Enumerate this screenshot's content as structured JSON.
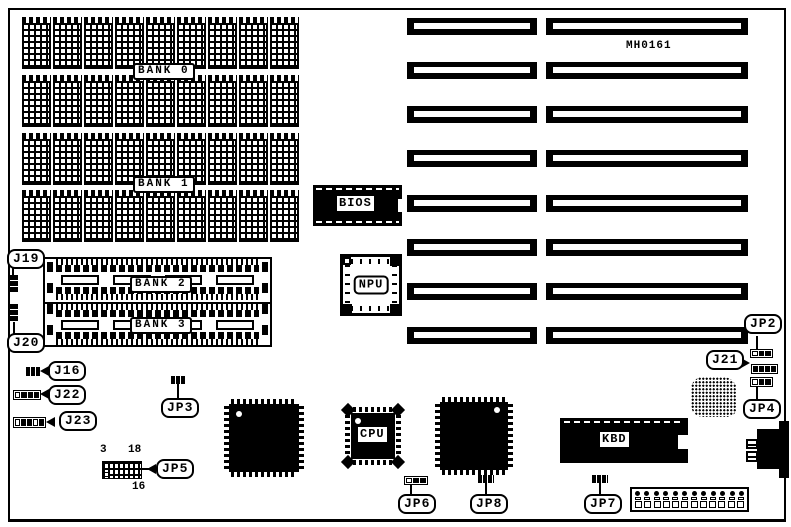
{
  "board": {
    "id_text": "MH0161",
    "dip_memory": {
      "rows": 4,
      "chips_per_row": 9,
      "banks": [
        {
          "label": "BANK 0"
        },
        {
          "label": "BANK 1"
        }
      ]
    },
    "simm_memory": {
      "banks": [
        {
          "label": "BANK 2"
        },
        {
          "label": "BANK 3"
        }
      ]
    },
    "chips": {
      "bios": "BIOS",
      "npu": "NPU",
      "cpu": "CPU",
      "kbd": "KBD"
    },
    "expansion_slots": {
      "rows": 8,
      "columns": 2
    },
    "power_connector": {
      "positions": 12
    },
    "callouts": {
      "j19": "J19",
      "j20": "J20",
      "j16": "J16",
      "j22": "J22",
      "j23": "J23",
      "jp3": "JP3",
      "jp5": "JP5",
      "jp6": "JP6",
      "jp8": "JP8",
      "jp7": "JP7",
      "jp2": "JP2",
      "j21": "J21",
      "jp4": "JP4"
    },
    "jp5_pin_labels": {
      "top_left": "3",
      "top_right": "18",
      "bottom": "16"
    }
  },
  "colors": {
    "ink": "#000000",
    "paper": "#ffffff"
  }
}
